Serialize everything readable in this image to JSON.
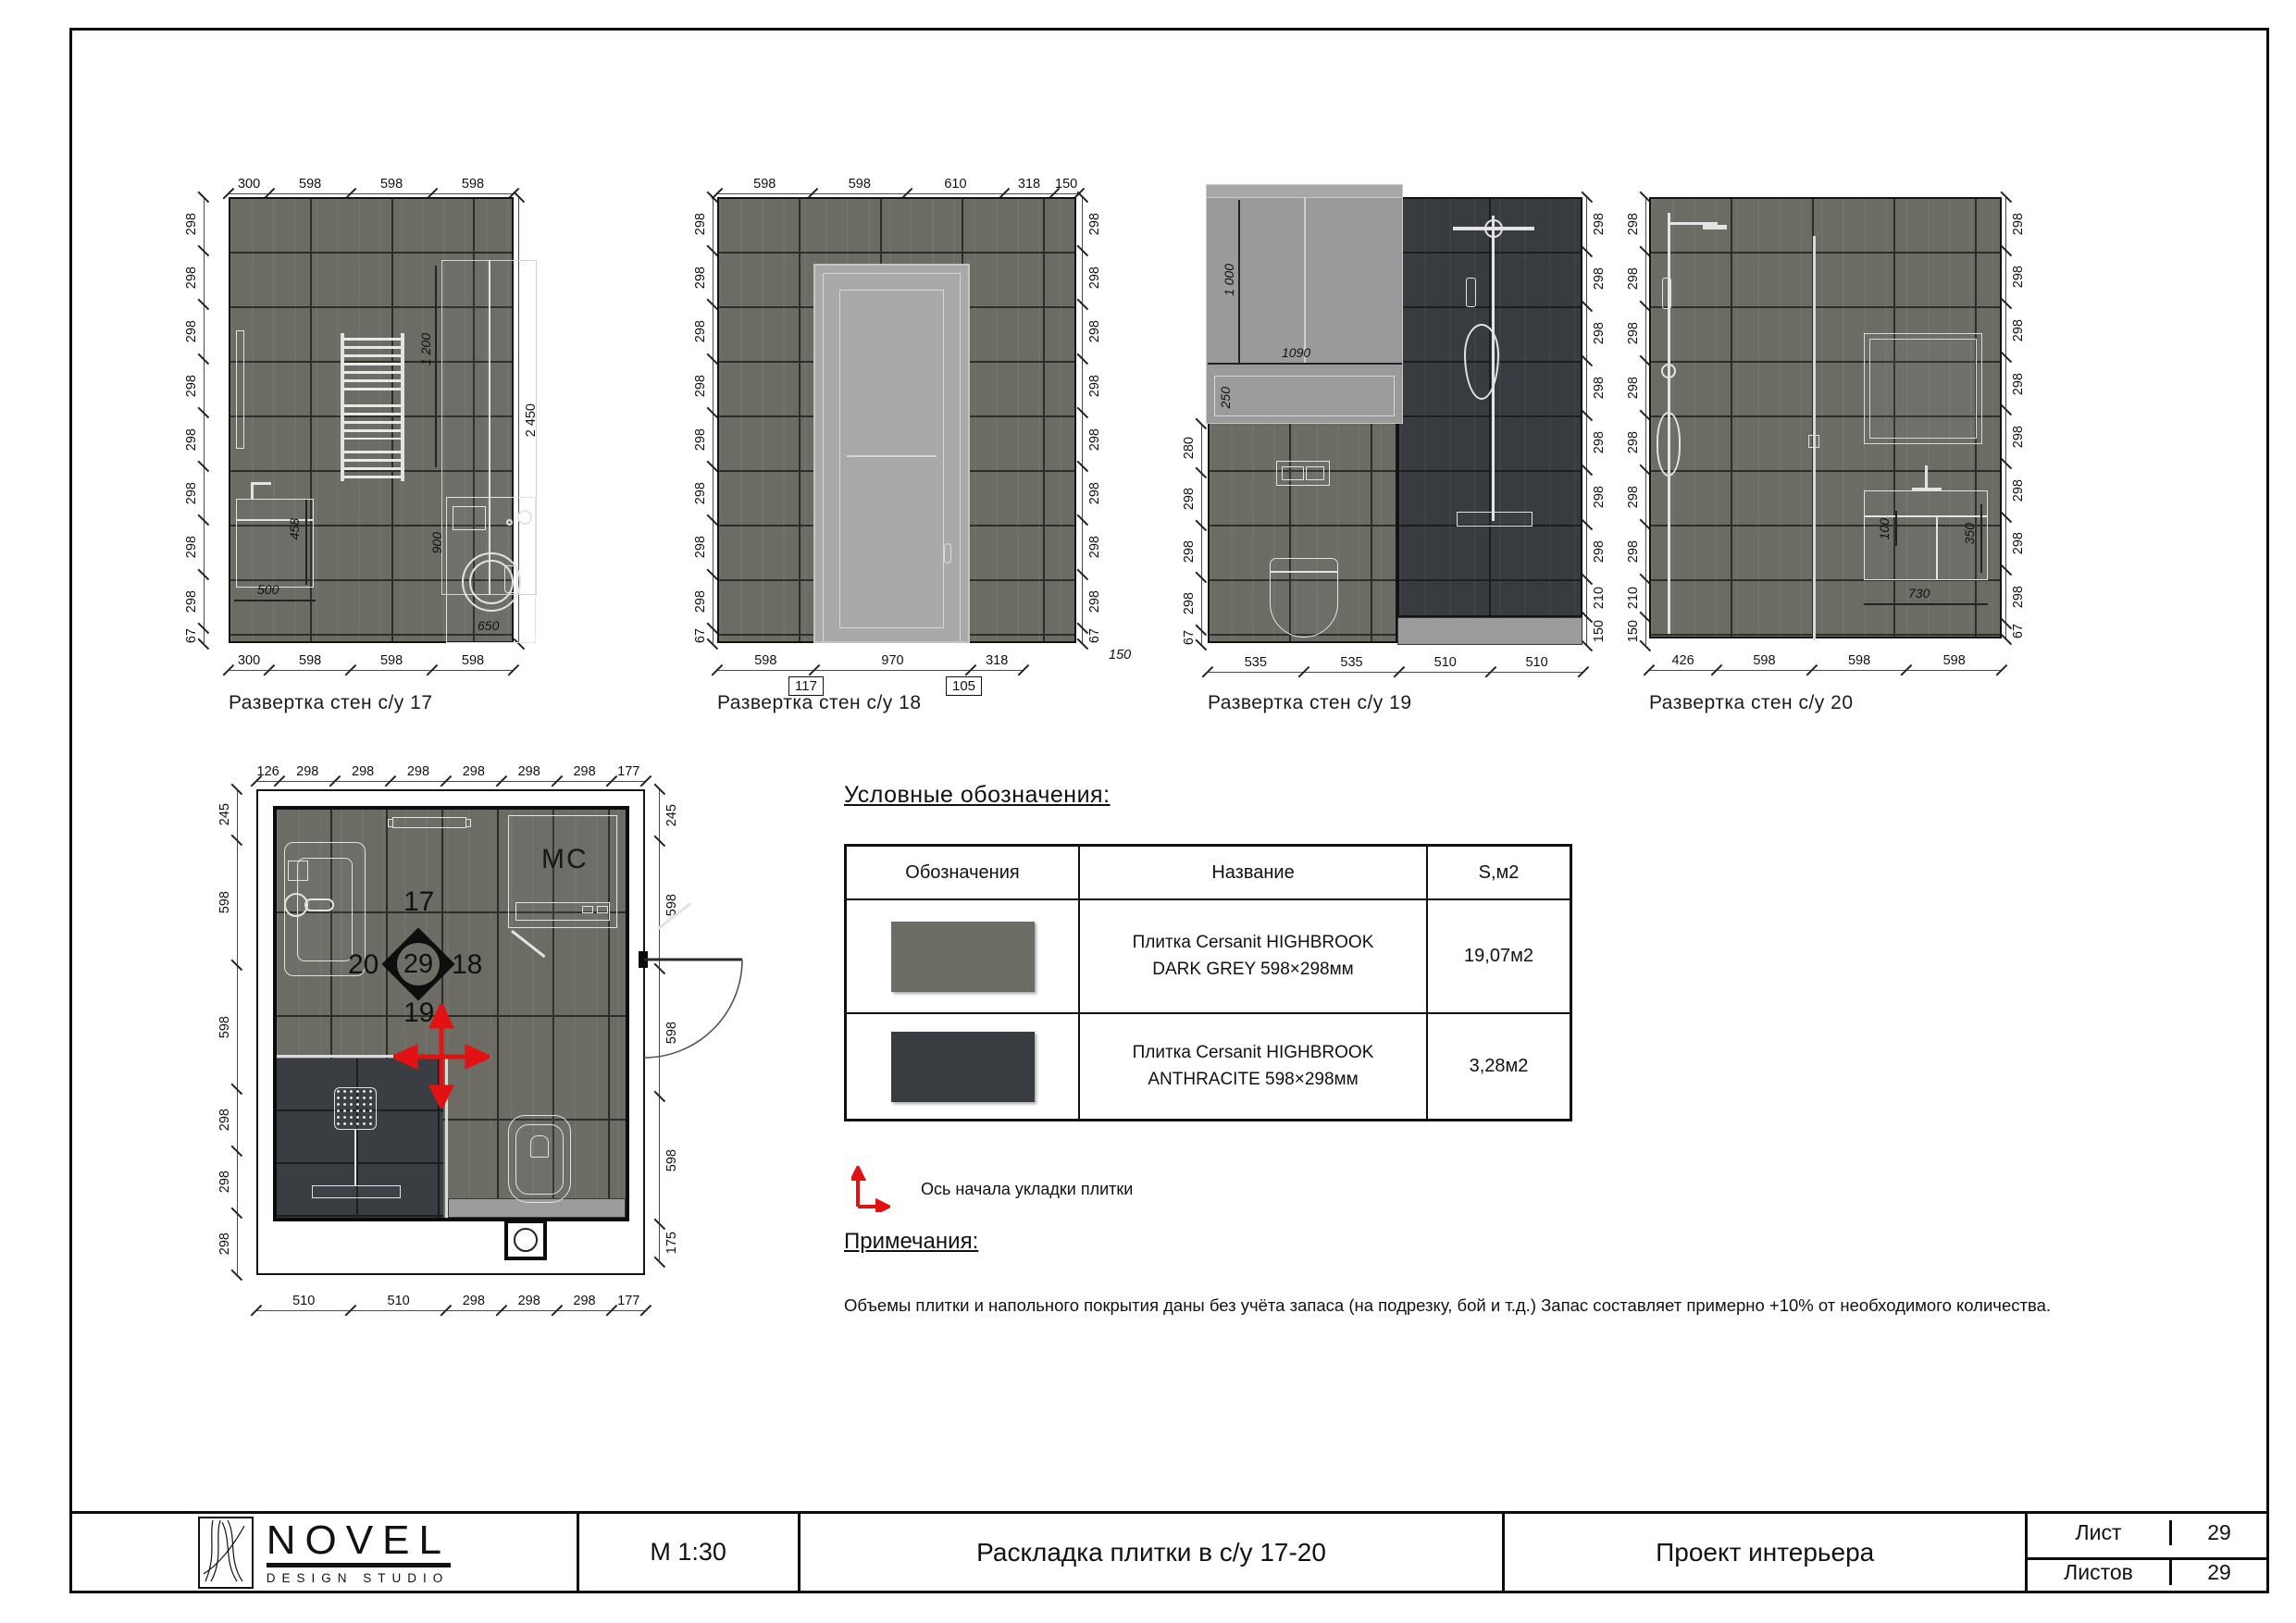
{
  "colors": {
    "tile_grey": "#6c6c65",
    "tile_anthracite": "#383b3f",
    "floor_strip": "#9c9c9c",
    "door": "#a9a9a9",
    "axis_red": "#e31212"
  },
  "elevations": [
    {
      "caption": "Развертка стен с/у 17",
      "top_dims": [
        "300",
        "598",
        "598",
        "598"
      ],
      "left_dims": [
        "298",
        "298",
        "298",
        "298",
        "298",
        "298",
        "298",
        "298",
        "67"
      ],
      "right_dims": [
        "2 450"
      ],
      "bottom_dims": [
        "300",
        "598",
        "598",
        "598"
      ],
      "inner": {
        "cabinet_height": "1 200",
        "sink_height": "458",
        "sink_width": "500",
        "washer_height": "900",
        "washer_width": "650"
      }
    },
    {
      "caption": "Развертка стен с/у 18",
      "top_dims": [
        "598",
        "598",
        "610",
        "318",
        "150"
      ],
      "left_dims": [
        "298",
        "298",
        "298",
        "298",
        "298",
        "298",
        "298",
        "298",
        "67"
      ],
      "right_dims": [
        "298",
        "298",
        "298",
        "298",
        "298",
        "298",
        "298",
        "298",
        "67"
      ],
      "bottom_dims": [
        "598",
        "970",
        "318"
      ],
      "boxed_dims": [
        "117",
        "105"
      ],
      "corner_br": "150"
    },
    {
      "caption": "Развертка стен с/у 19",
      "left_dims": [
        "280",
        "298",
        "298",
        "298",
        "67"
      ],
      "right_dims": [
        "298",
        "298",
        "298",
        "298",
        "298",
        "298",
        "298",
        "210",
        "150"
      ],
      "bottom_dims": [
        "535",
        "535",
        "510",
        "510"
      ],
      "inner": {
        "cabinet_height": "1 000",
        "shelf_height": "250",
        "cabinet_width": "1090"
      }
    },
    {
      "caption": "Развертка стен с/у 20",
      "left_dims": [
        "298",
        "298",
        "298",
        "298",
        "298",
        "298",
        "298",
        "210",
        "150"
      ],
      "right_dims": [
        "298",
        "298",
        "298",
        "298",
        "298",
        "298",
        "298",
        "298",
        "67"
      ],
      "bottom_dims": [
        "426",
        "598",
        "598",
        "598"
      ],
      "inner": {
        "vanity_inset": "100",
        "vanity_height": "350",
        "vanity_width": "730"
      }
    }
  ],
  "plan": {
    "top_dims": [
      "126",
      "298",
      "298",
      "298",
      "298",
      "298",
      "298",
      "177"
    ],
    "bottom_dims": [
      "510",
      "510",
      "298",
      "298",
      "298",
      "177"
    ],
    "left_dims": [
      "245",
      "598",
      "598",
      "298",
      "298",
      "298"
    ],
    "right_dims": [
      "245",
      "598",
      "598",
      "598",
      "175"
    ],
    "marker": {
      "up": "17",
      "right": "18",
      "down": "19",
      "left": "20",
      "center": "29"
    },
    "washer_label": "МС"
  },
  "legend": {
    "title": "Условные обозначения:",
    "table": {
      "headers": [
        "Обозначения",
        "Название",
        "S,м2"
      ],
      "rows": [
        {
          "swatch": "#6c6c65",
          "name": "Плитка Cersanit HIGHBROOK DARK GREY 598×298мм",
          "area": "19,07м2"
        },
        {
          "swatch": "#383b3f",
          "name": "Плитка Cersanit HIGHBROOK ANTHRACITE  598×298мм",
          "area": "3,28м2"
        }
      ]
    },
    "axis_note": "Ось начала укладки плитки"
  },
  "notes": {
    "title": "Примечания:",
    "text": "Объемы плитки и напольного покрытия даны без учёта запаса (на подрезку, бой и т.д.) Запас составляет примерно +10% от необходимого количества."
  },
  "titleblock": {
    "logo_name": "NOVEL",
    "logo_sub": "DESIGN STUDIO",
    "scale": "М 1:30",
    "drawing_title": "Раскладка плитки в с/у 17-20",
    "project": "Проект интерьера",
    "sheet_label": "Лист",
    "sheet_number": "29",
    "sheets_label": "Листов",
    "sheets_total": "29"
  }
}
